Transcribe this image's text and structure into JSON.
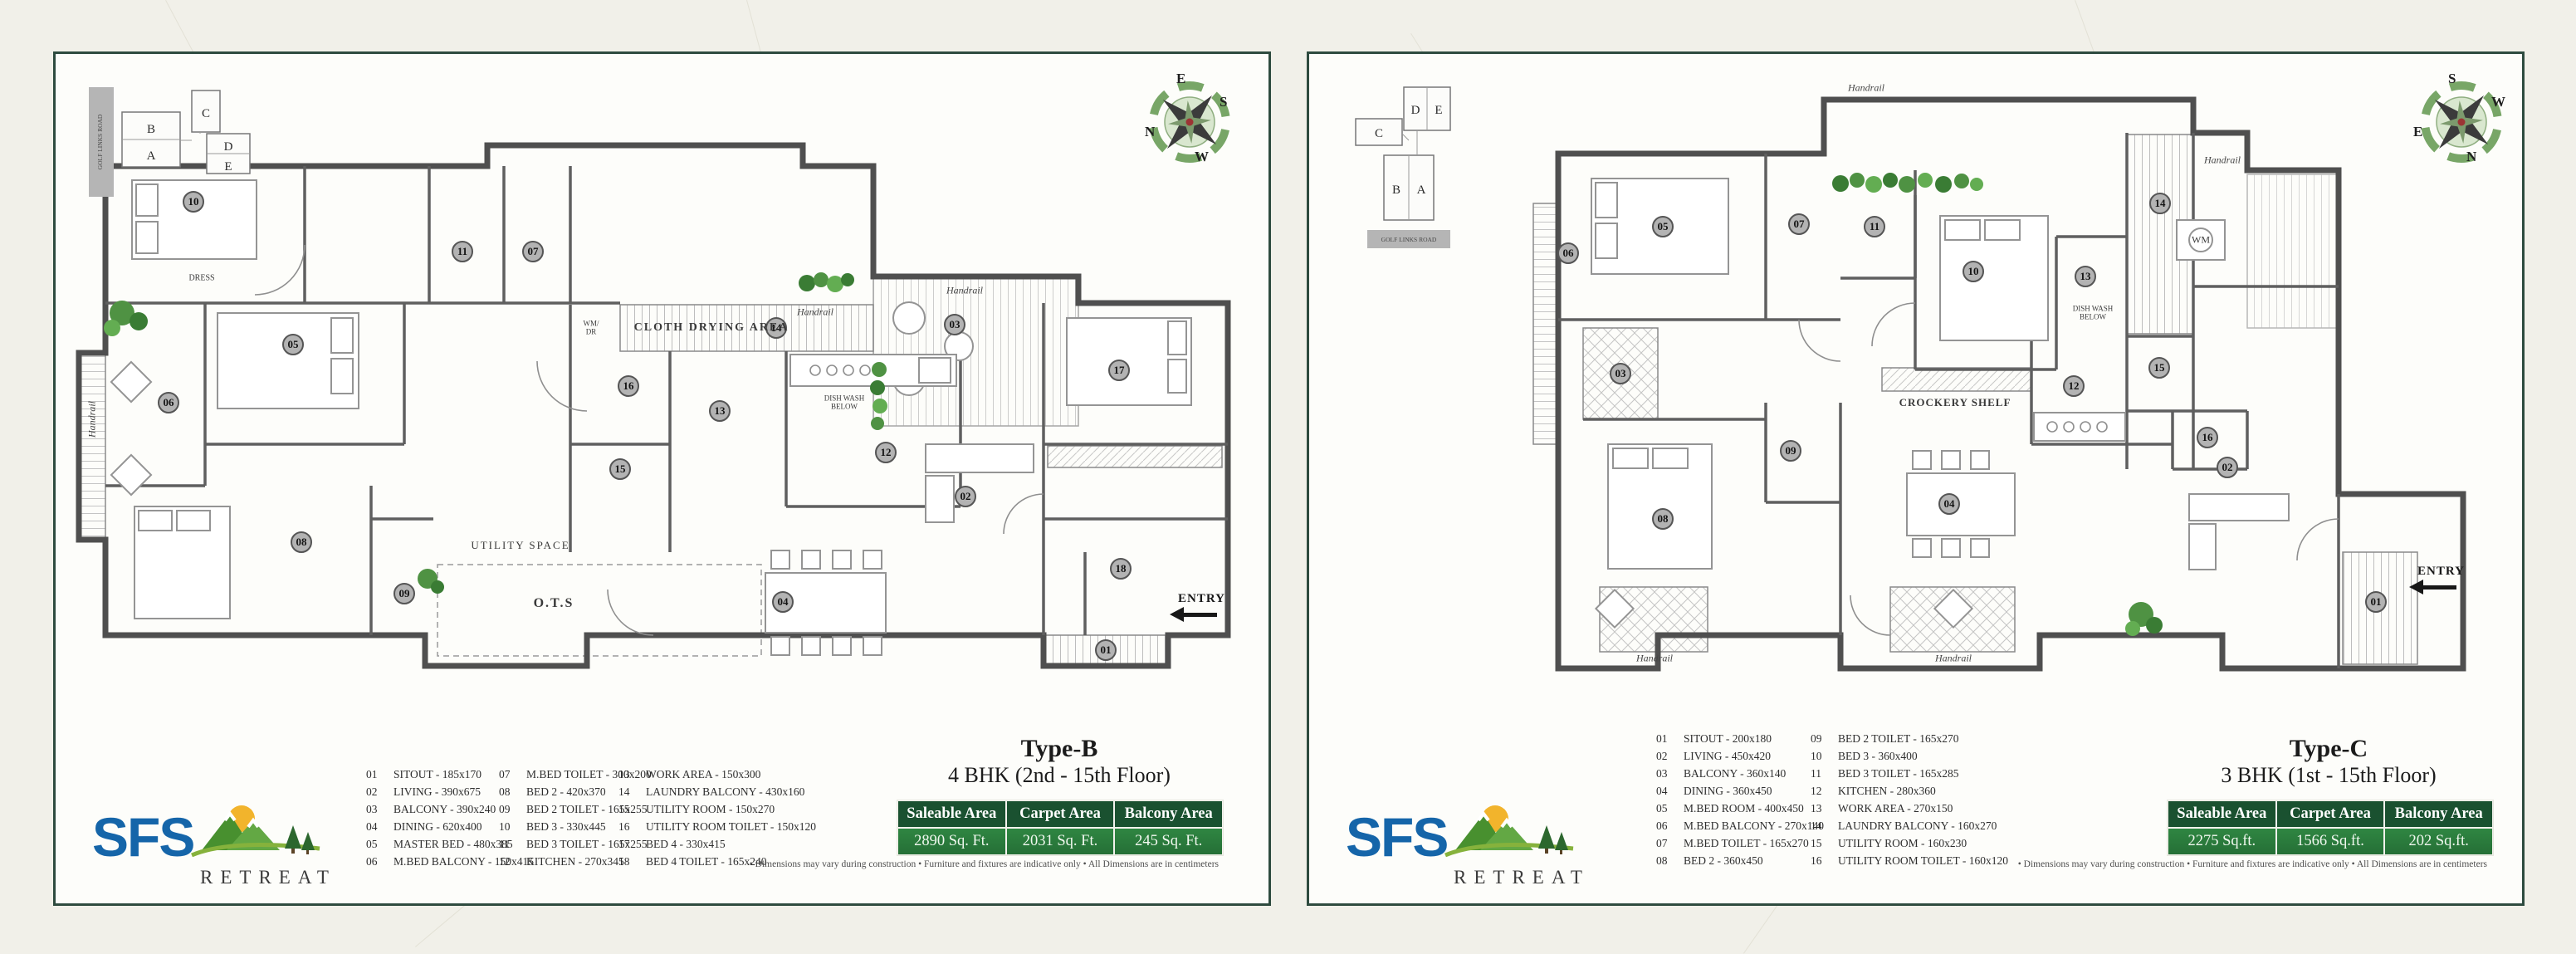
{
  "page": {
    "background": "#f1f0e9",
    "card_background": "#fdfdfa",
    "card_border": "#2e4b3f"
  },
  "brand": {
    "name": "SFS",
    "tagline": "RETREAT",
    "blue": "#1565a9",
    "sun": "#f2b42c",
    "mountain_dark": "#48902f",
    "mountain_light": "#63a844",
    "pine": "#2c672e",
    "swoosh": "#86b23c"
  },
  "shared": {
    "table_headers": [
      "Saleable Area",
      "Carpet Area",
      "Balcony Area"
    ],
    "disclaimer": "• Dimensions may vary during construction   • Furniture and fixtures are indicative only   • All Dimensions are in centimeters",
    "entry_label": "ENTRY",
    "handrail_label": "Handrail",
    "table_header_bg": "#1a5130",
    "table_value_bg": "#2c7d3c"
  },
  "panel_b": {
    "title": "Type-B",
    "subtitle": "4 BHK (2nd - 15th Floor)",
    "areas": {
      "saleable": "2890 Sq. Ft.",
      "carpet": "2031 Sq. Ft.",
      "balcony": "245 Sq. Ft."
    },
    "key_plan": {
      "road": "GOLF LINKS ROAD",
      "blocks": [
        "B",
        "A",
        "C",
        "D",
        "E"
      ]
    },
    "compass": {
      "top": "E",
      "right": "S",
      "bottom": "W",
      "left": "N"
    },
    "labels": {
      "cloth_drying": "CLOTH DRYING AREA",
      "utility_space": "UTILITY SPACE",
      "ots": "O.T.S",
      "dress": "DRESS",
      "dish_wash": "DISH WASH BELOW",
      "wm_dr": "WM/ DR"
    },
    "legend": [
      {
        "no": "01",
        "text": "SITOUT - 185x170"
      },
      {
        "no": "02",
        "text": "LIVING - 390x675"
      },
      {
        "no": "03",
        "text": "BALCONY - 390x240"
      },
      {
        "no": "04",
        "text": "DINING - 620x400"
      },
      {
        "no": "05",
        "text": "MASTER BED - 480x385"
      },
      {
        "no": "06",
        "text": "M.BED BALCONY - 150x415"
      },
      {
        "no": "07",
        "text": "M.BED TOILET - 300x200"
      },
      {
        "no": "08",
        "text": "BED 2 - 420x370"
      },
      {
        "no": "09",
        "text": "BED 2 TOILET - 165x255"
      },
      {
        "no": "10",
        "text": "BED 3 - 330x445"
      },
      {
        "no": "11",
        "text": "BED 3 TOILET - 165x255"
      },
      {
        "no": "12",
        "text": "KITCHEN - 270x345"
      },
      {
        "no": "13",
        "text": "WORK AREA - 150x300"
      },
      {
        "no": "14",
        "text": "LAUNDRY BALCONY - 430x160"
      },
      {
        "no": "15",
        "text": "UTILITY ROOM - 150x270"
      },
      {
        "no": "16",
        "text": "UTILITY ROOM TOILET - 150x120"
      },
      {
        "no": "17",
        "text": "BED 4 - 330x415"
      },
      {
        "no": "18",
        "text": "BED 4 TOILET - 165x240"
      }
    ],
    "markers": [
      "01",
      "02",
      "03",
      "04",
      "05",
      "06",
      "07",
      "08",
      "09",
      "10",
      "11",
      "12",
      "13",
      "14",
      "15",
      "16",
      "17",
      "18"
    ]
  },
  "panel_c": {
    "title": "Type-C",
    "subtitle": "3 BHK (1st - 15th Floor)",
    "areas": {
      "saleable": "2275 Sq.ft.",
      "carpet": "1566 Sq.ft.",
      "balcony": "202 Sq.ft."
    },
    "key_plan": {
      "road": "GOLF LINKS ROAD",
      "blocks": [
        "D",
        "E",
        "C",
        "B",
        "A"
      ]
    },
    "compass": {
      "top": "S",
      "right": "W",
      "bottom": "N",
      "left": "E"
    },
    "labels": {
      "crockery": "CROCKERY SHELF",
      "dish_wash": "DISH WASH BELOW",
      "wm": "WM"
    },
    "legend": [
      {
        "no": "01",
        "text": "SITOUT - 200x180"
      },
      {
        "no": "02",
        "text": "LIVING - 450x420"
      },
      {
        "no": "03",
        "text": "BALCONY - 360x140"
      },
      {
        "no": "04",
        "text": "DINING - 360x450"
      },
      {
        "no": "05",
        "text": "M.BED ROOM - 400x450"
      },
      {
        "no": "06",
        "text": "M.BED BALCONY - 270x140"
      },
      {
        "no": "07",
        "text": "M.BED TOILET - 165x270"
      },
      {
        "no": "08",
        "text": "BED 2 - 360x450"
      },
      {
        "no": "09",
        "text": "BED 2 TOILET - 165x270"
      },
      {
        "no": "10",
        "text": "BED 3 - 360x400"
      },
      {
        "no": "11",
        "text": "BED 3 TOILET - 165x285"
      },
      {
        "no": "12",
        "text": "KITCHEN - 280x360"
      },
      {
        "no": "13",
        "text": "WORK AREA - 270x150"
      },
      {
        "no": "14",
        "text": "LAUNDRY BALCONY - 160x270"
      },
      {
        "no": "15",
        "text": "UTILITY ROOM - 160x230"
      },
      {
        "no": "16",
        "text": "UTILITY ROOM TOILET - 160x120"
      }
    ],
    "markers": [
      "01",
      "02",
      "03",
      "04",
      "05",
      "06",
      "07",
      "08",
      "09",
      "10",
      "11",
      "12",
      "13",
      "14",
      "15",
      "16"
    ]
  }
}
